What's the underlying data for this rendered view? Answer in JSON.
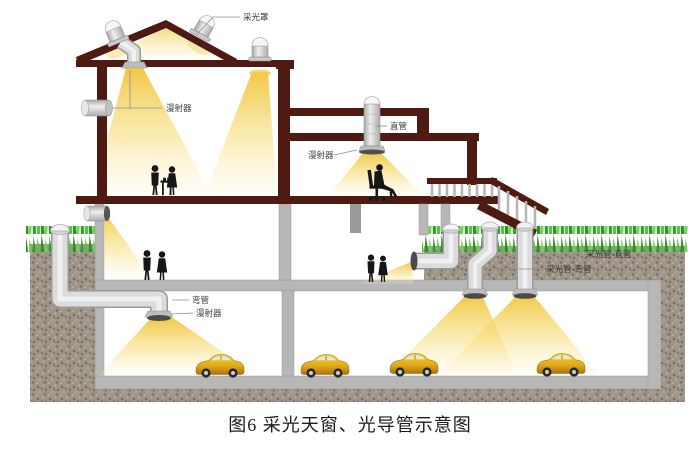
{
  "figure": {
    "caption": "图6 采光天窗、光导管示意图"
  },
  "labels": {
    "collector_dome": "采光罩",
    "diffuser_room1": "漫射器",
    "straight_pipe": "直管",
    "diffuser_room2": "漫射器",
    "pipe_straight_full": "采光管-直管",
    "pipe_bent_full": "采光管-弯管",
    "bent_pipe": "弯管",
    "diffuser_basement": "漫射器"
  },
  "colors": {
    "roof_maroon": "#4e1a12",
    "light_yellow": "#f0c43c",
    "grass_green": "#3aa832",
    "soil": "#9e9488",
    "concrete": "#b7b7b7",
    "pipe_silver": "#dcdcdc",
    "car_yellow": "#eebd1e",
    "silhouette": "#161616"
  }
}
